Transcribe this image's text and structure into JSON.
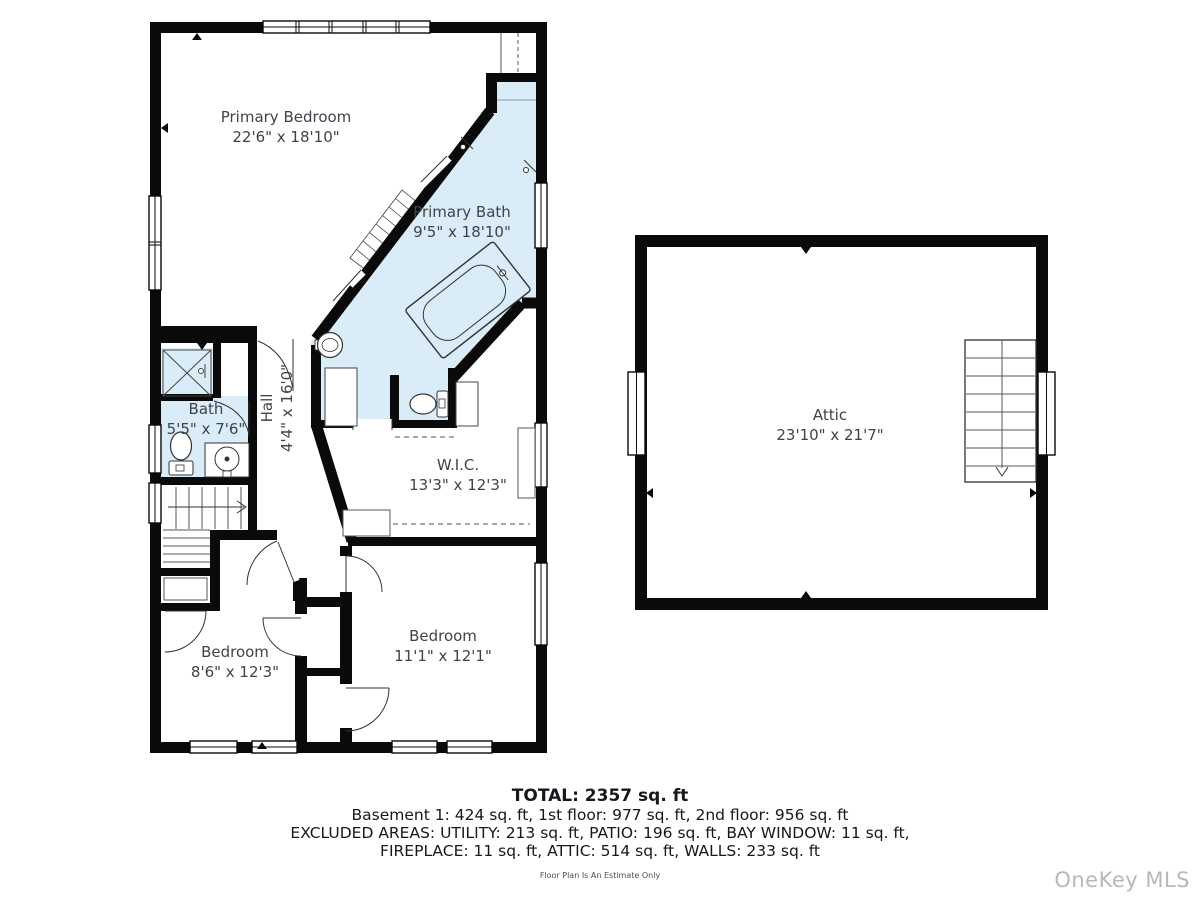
{
  "floorplan": {
    "rooms": [
      {
        "name": "Primary Bedroom",
        "dims": "22'6\" x 18'10\""
      },
      {
        "name": "Primary Bath",
        "dims": "9'5\" x 18'10\""
      },
      {
        "name": "Bath",
        "dims": "5'5\" x 7'6\""
      },
      {
        "name": "Hall",
        "dims": "4'4\" x 16'0\""
      },
      {
        "name": "W.I.C.",
        "dims": "13'3\" x 12'3\""
      },
      {
        "name": "Bedroom",
        "dims": "8'6\" x 12'3\""
      },
      {
        "name": "Bedroom",
        "dims": "11'1\" x 12'1\""
      },
      {
        "name": "Attic",
        "dims": "23'10\" x 21'7\""
      }
    ]
  },
  "summary": {
    "total": "TOTAL: 2357 sq. ft",
    "line1": "Basement 1: 424 sq. ft, 1st floor: 977 sq. ft, 2nd floor: 956 sq. ft",
    "line2": "EXCLUDED AREAS: UTILITY: 213 sq. ft, PATIO: 196 sq. ft, BAY WINDOW: 11 sq. ft,",
    "line3": "FIREPLACE: 11 sq. ft, ATTIC: 514 sq. ft, WALLS: 233 sq. ft",
    "disclaimer": "Floor Plan Is An Estimate Only"
  },
  "watermark": "OneKey MLS",
  "colors": {
    "wall": "#0a0a0a",
    "bath_fill": "#d9ecf8",
    "label_text": "#3d444b",
    "watermark": "#b5b9bd"
  }
}
